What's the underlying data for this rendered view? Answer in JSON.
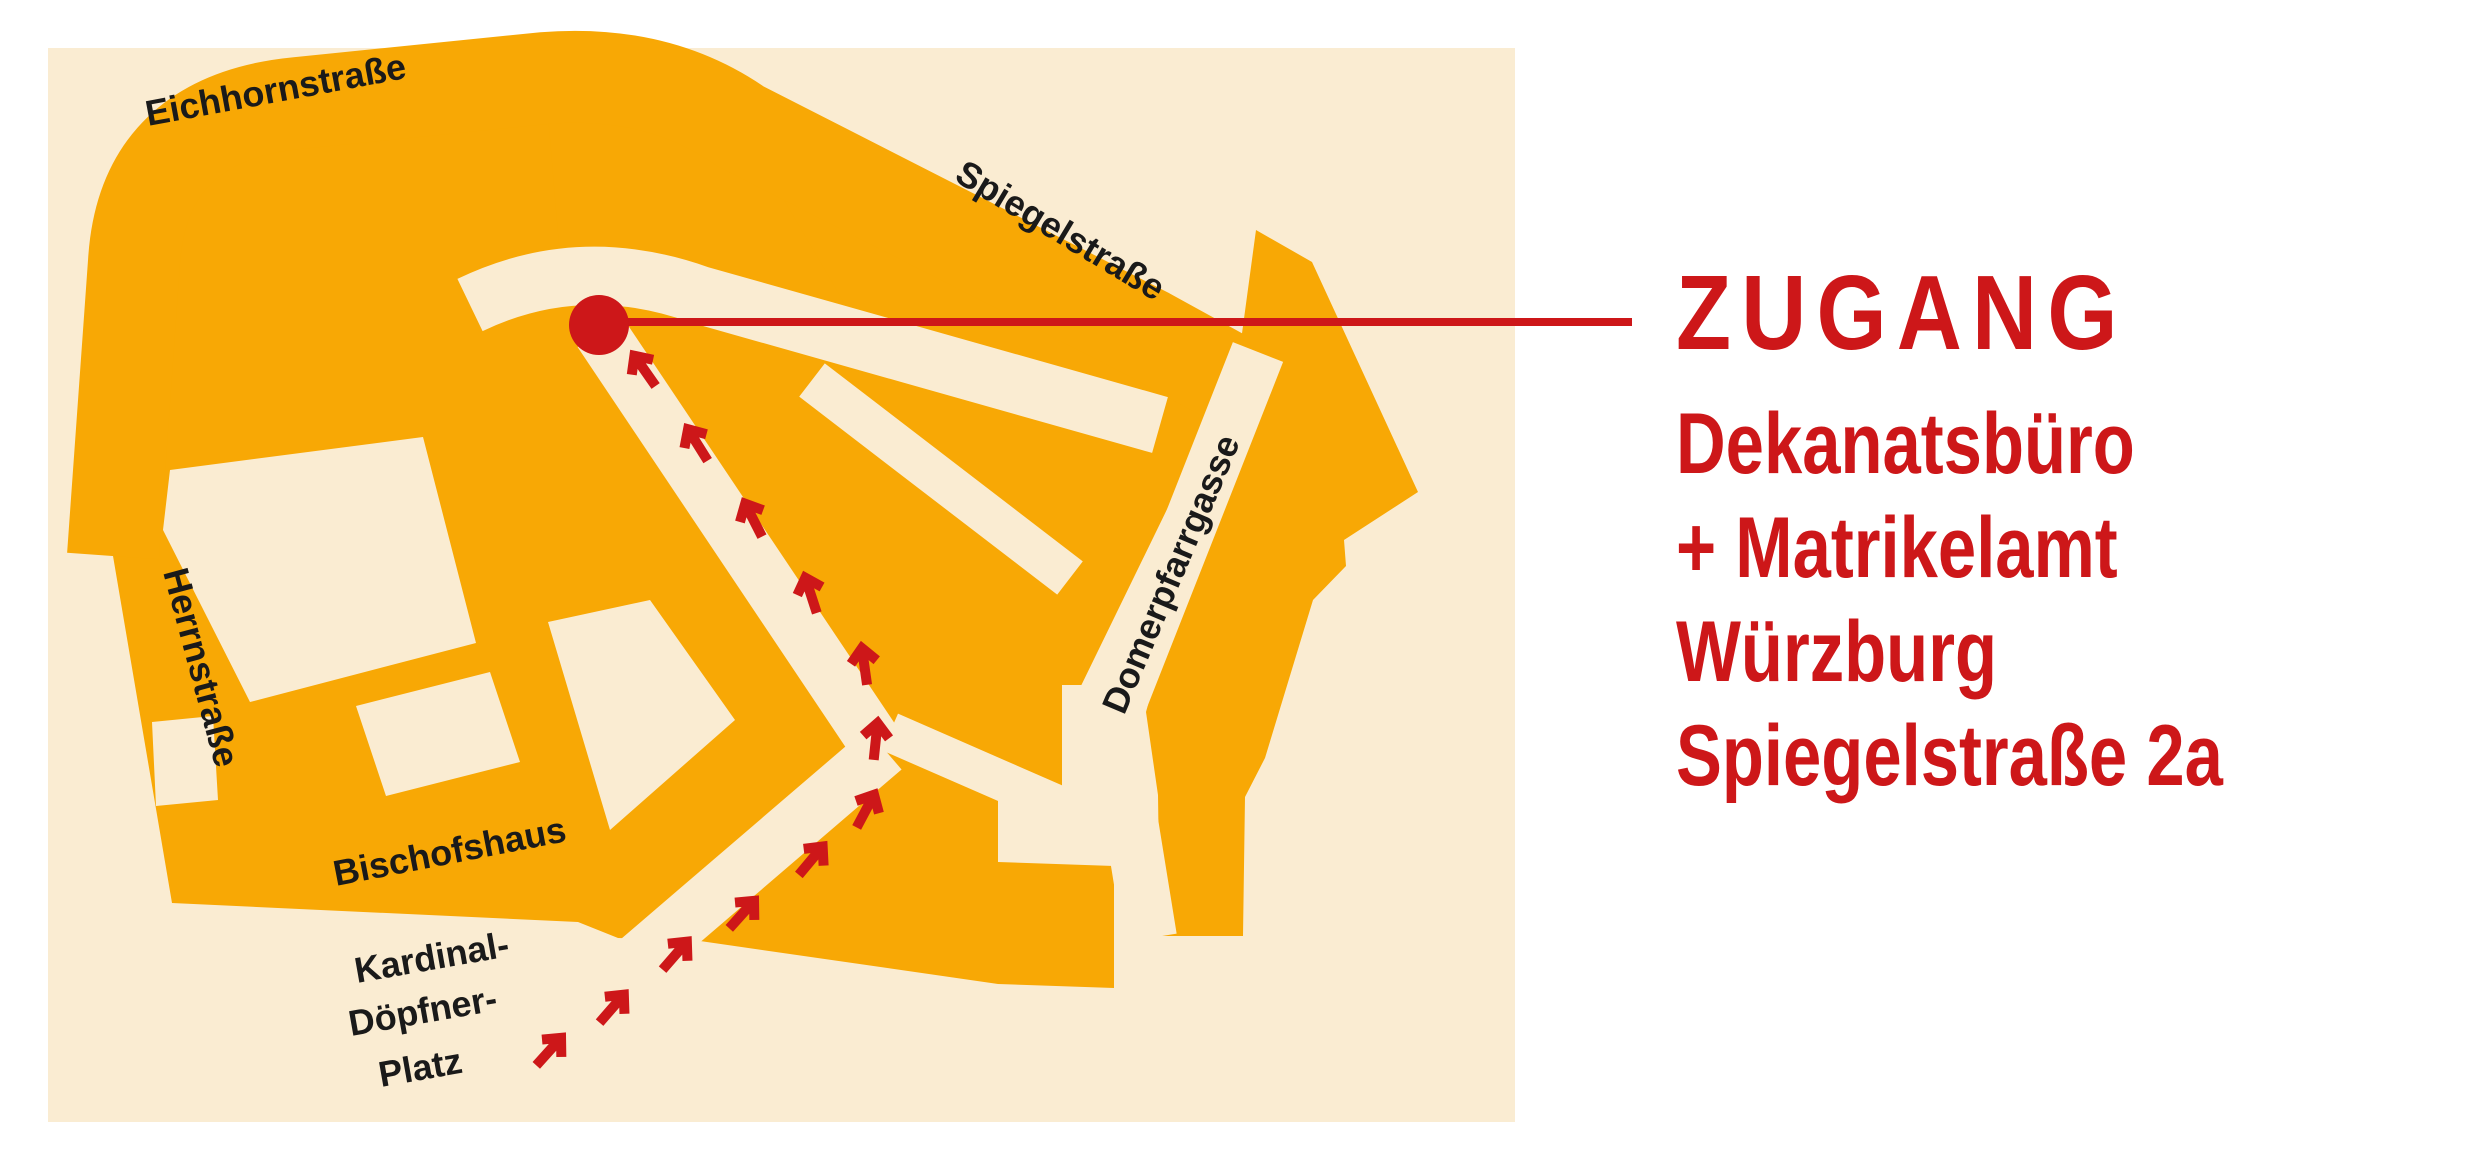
{
  "colors": {
    "building_orange": "#F8A805",
    "street_cream": "#FAECD2",
    "accent_red": "#CD1719",
    "label_black": "#1a1a1a",
    "page_white": "#ffffff"
  },
  "map": {
    "streets": {
      "eichhornstrasse": "Eichhornstraße",
      "spiegelstrasse": "Spiegelstraße",
      "herrnstrasse": "Herrnstraße",
      "domerpfarrgasse": "Domerpfarrgasse"
    },
    "places": {
      "bischofshaus": "Bischofshaus",
      "kardinal_line1": "Kardinal-",
      "kardinal_line2": "Döpfner-",
      "kardinal_line3": "Platz"
    },
    "marker": {
      "meaning": "Zugang / entrance point on Spiegelstraße"
    }
  },
  "legend": {
    "title": "ZUGANG",
    "lines": [
      "Dekanatsbüro",
      "+ Matrikelamt",
      "Würzburg",
      "Spiegelstraße 2a"
    ]
  }
}
